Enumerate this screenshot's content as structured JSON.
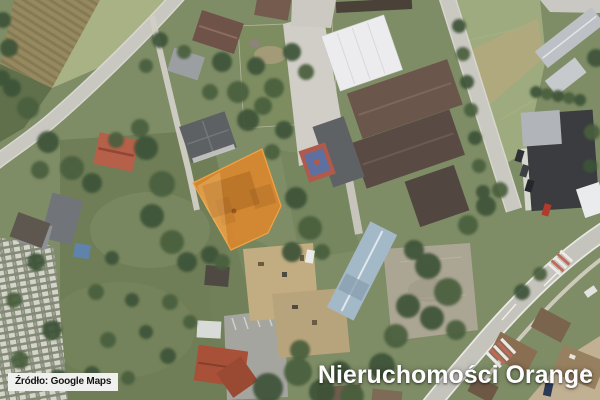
{
  "attribution": {
    "source_label": "Źródło: Google Maps"
  },
  "branding": {
    "watermark": "Nieruchomości Orange"
  },
  "highlight": {
    "parcel_fill": "#D9882F",
    "parcel_outline": "#F5A544",
    "description": "orange-highlighted-property-parcel"
  },
  "map": {
    "kind": "satellite-imagery",
    "status_colors": {
      "vegetation_green": "#7e8d66",
      "road_gray": "#c6c5be",
      "sports_court_red": "#b05a4c",
      "sports_court_blue": "#5e70a0"
    }
  }
}
